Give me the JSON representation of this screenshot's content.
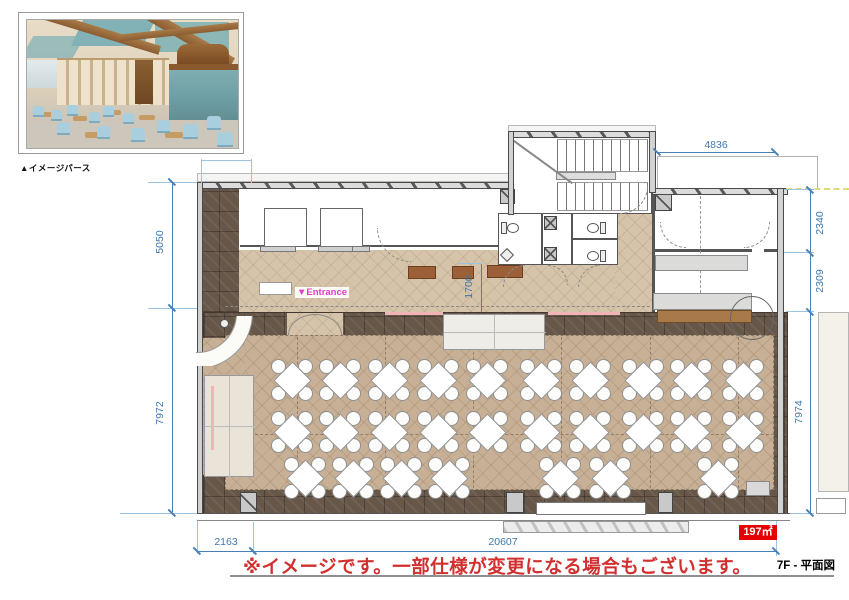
{
  "inset": {
    "caption": "▲イメージパース"
  },
  "plan": {
    "entrance_label": "▼Entrance",
    "area_label": "197㎡",
    "dimensions": {
      "top": "4836",
      "right_upper": "2340",
      "right_mid": "2309",
      "right_main": "7974",
      "left_upper": "5050",
      "left_lower": "7972",
      "bottom_left": "2163",
      "bottom_main": "20607",
      "entrance": "1700"
    },
    "tables": {
      "rows": [
        {
          "y": 380,
          "xs": [
            292,
            340,
            389,
            438,
            487,
            541,
            590,
            643,
            691,
            743
          ]
        },
        {
          "y": 432,
          "xs": [
            292,
            340,
            389,
            438,
            487,
            541,
            590,
            643,
            691,
            743
          ]
        },
        {
          "y": 478,
          "xs": [
            305,
            353,
            401,
            449,
            560,
            610,
            718
          ]
        }
      ]
    }
  },
  "footer": {
    "disclaimer": "※イメージです。一部仕様が変更になる場合もございます。",
    "sheet_label": "7F - 平面図"
  },
  "colors": {
    "dimension_blue": "#4a7fb5",
    "disclaimer_red": "#d22f2f",
    "area_badge_red": "#e60000",
    "entrance_magenta": "#e03cc8",
    "floor_dark_tile": "#675749",
    "floor_parquet": "#c8b096"
  }
}
